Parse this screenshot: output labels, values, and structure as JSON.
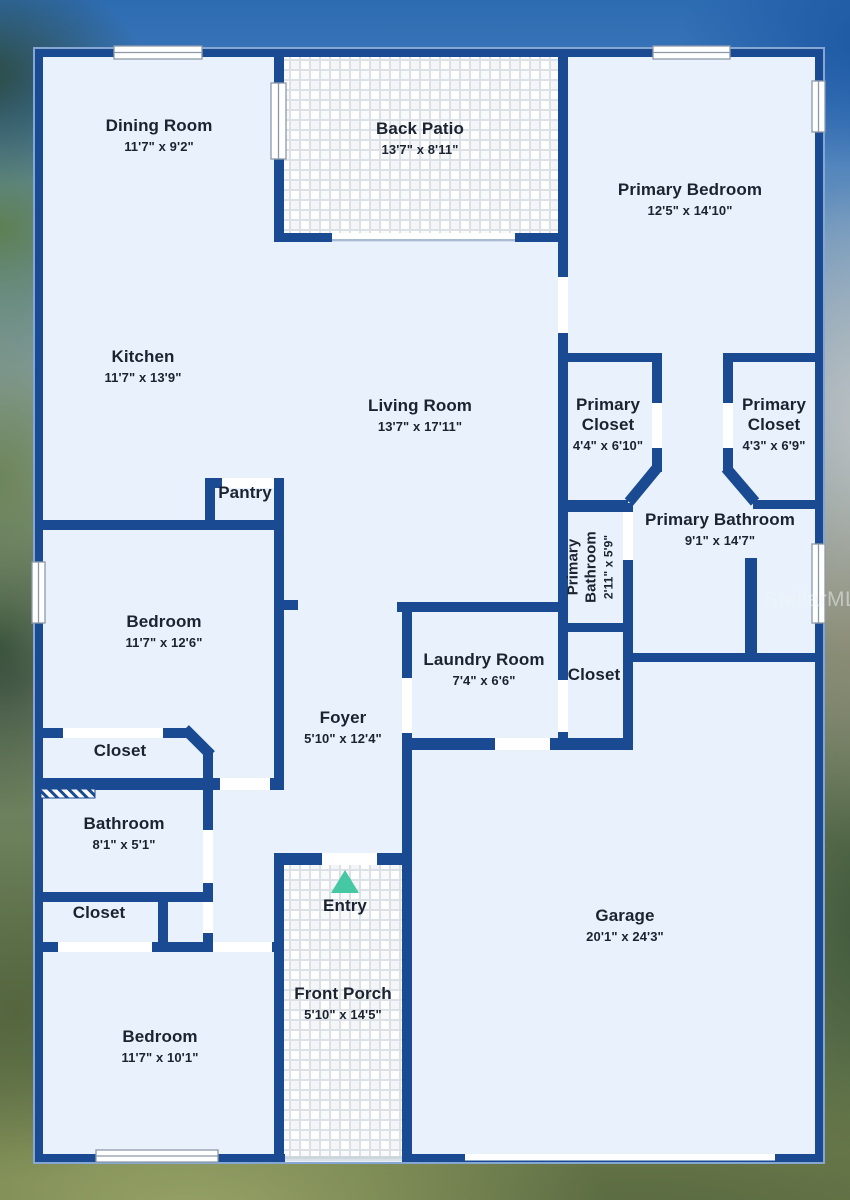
{
  "title": "Floor Plan",
  "watermark": "StellarMLS",
  "colors": {
    "wall": "#1a4b92",
    "floor": "#e9f2fc",
    "tile_grout": "#dce1e8",
    "entry_arrow": "#45c8a3",
    "label_text": "#1b2330"
  },
  "entry_marker": "triangle-up-icon",
  "rooms": [
    {
      "name": "Dining Room",
      "dims": "11'7\" x 9'2\""
    },
    {
      "name": "Back Patio",
      "dims": "13'7\" x 8'11\""
    },
    {
      "name": "Primary Bedroom",
      "dims": "12'5\" x 14'10\""
    },
    {
      "name": "Kitchen",
      "dims": "11'7\" x 13'9\""
    },
    {
      "name": "Living Room",
      "dims": "13'7\" x 17'11\""
    },
    {
      "name": "Primary Closet",
      "dims": "4'4\" x 6'10\""
    },
    {
      "name": "Primary Closet",
      "dims": "4'3\" x 6'9\""
    },
    {
      "name": "Pantry",
      "dims": ""
    },
    {
      "name": "Primary Bathroom",
      "dims": "9'1\" x 14'7\""
    },
    {
      "name": "Primary Bathroom",
      "dims": "2'11\" x 5'9\""
    },
    {
      "name": "Bedroom",
      "dims": "11'7\" x 12'6\""
    },
    {
      "name": "Laundry Room",
      "dims": "7'4\" x 6'6\""
    },
    {
      "name": "Closet",
      "dims": ""
    },
    {
      "name": "Foyer",
      "dims": "5'10\" x 12'4\""
    },
    {
      "name": "Closet",
      "dims": ""
    },
    {
      "name": "Bathroom",
      "dims": "8'1\" x 5'1\""
    },
    {
      "name": "Closet",
      "dims": ""
    },
    {
      "name": "Entry",
      "dims": ""
    },
    {
      "name": "Garage",
      "dims": "20'1\" x 24'3\""
    },
    {
      "name": "Front Porch",
      "dims": "5'10\" x 14'5\""
    },
    {
      "name": "Bedroom",
      "dims": "11'7\" x 10'1\""
    }
  ]
}
